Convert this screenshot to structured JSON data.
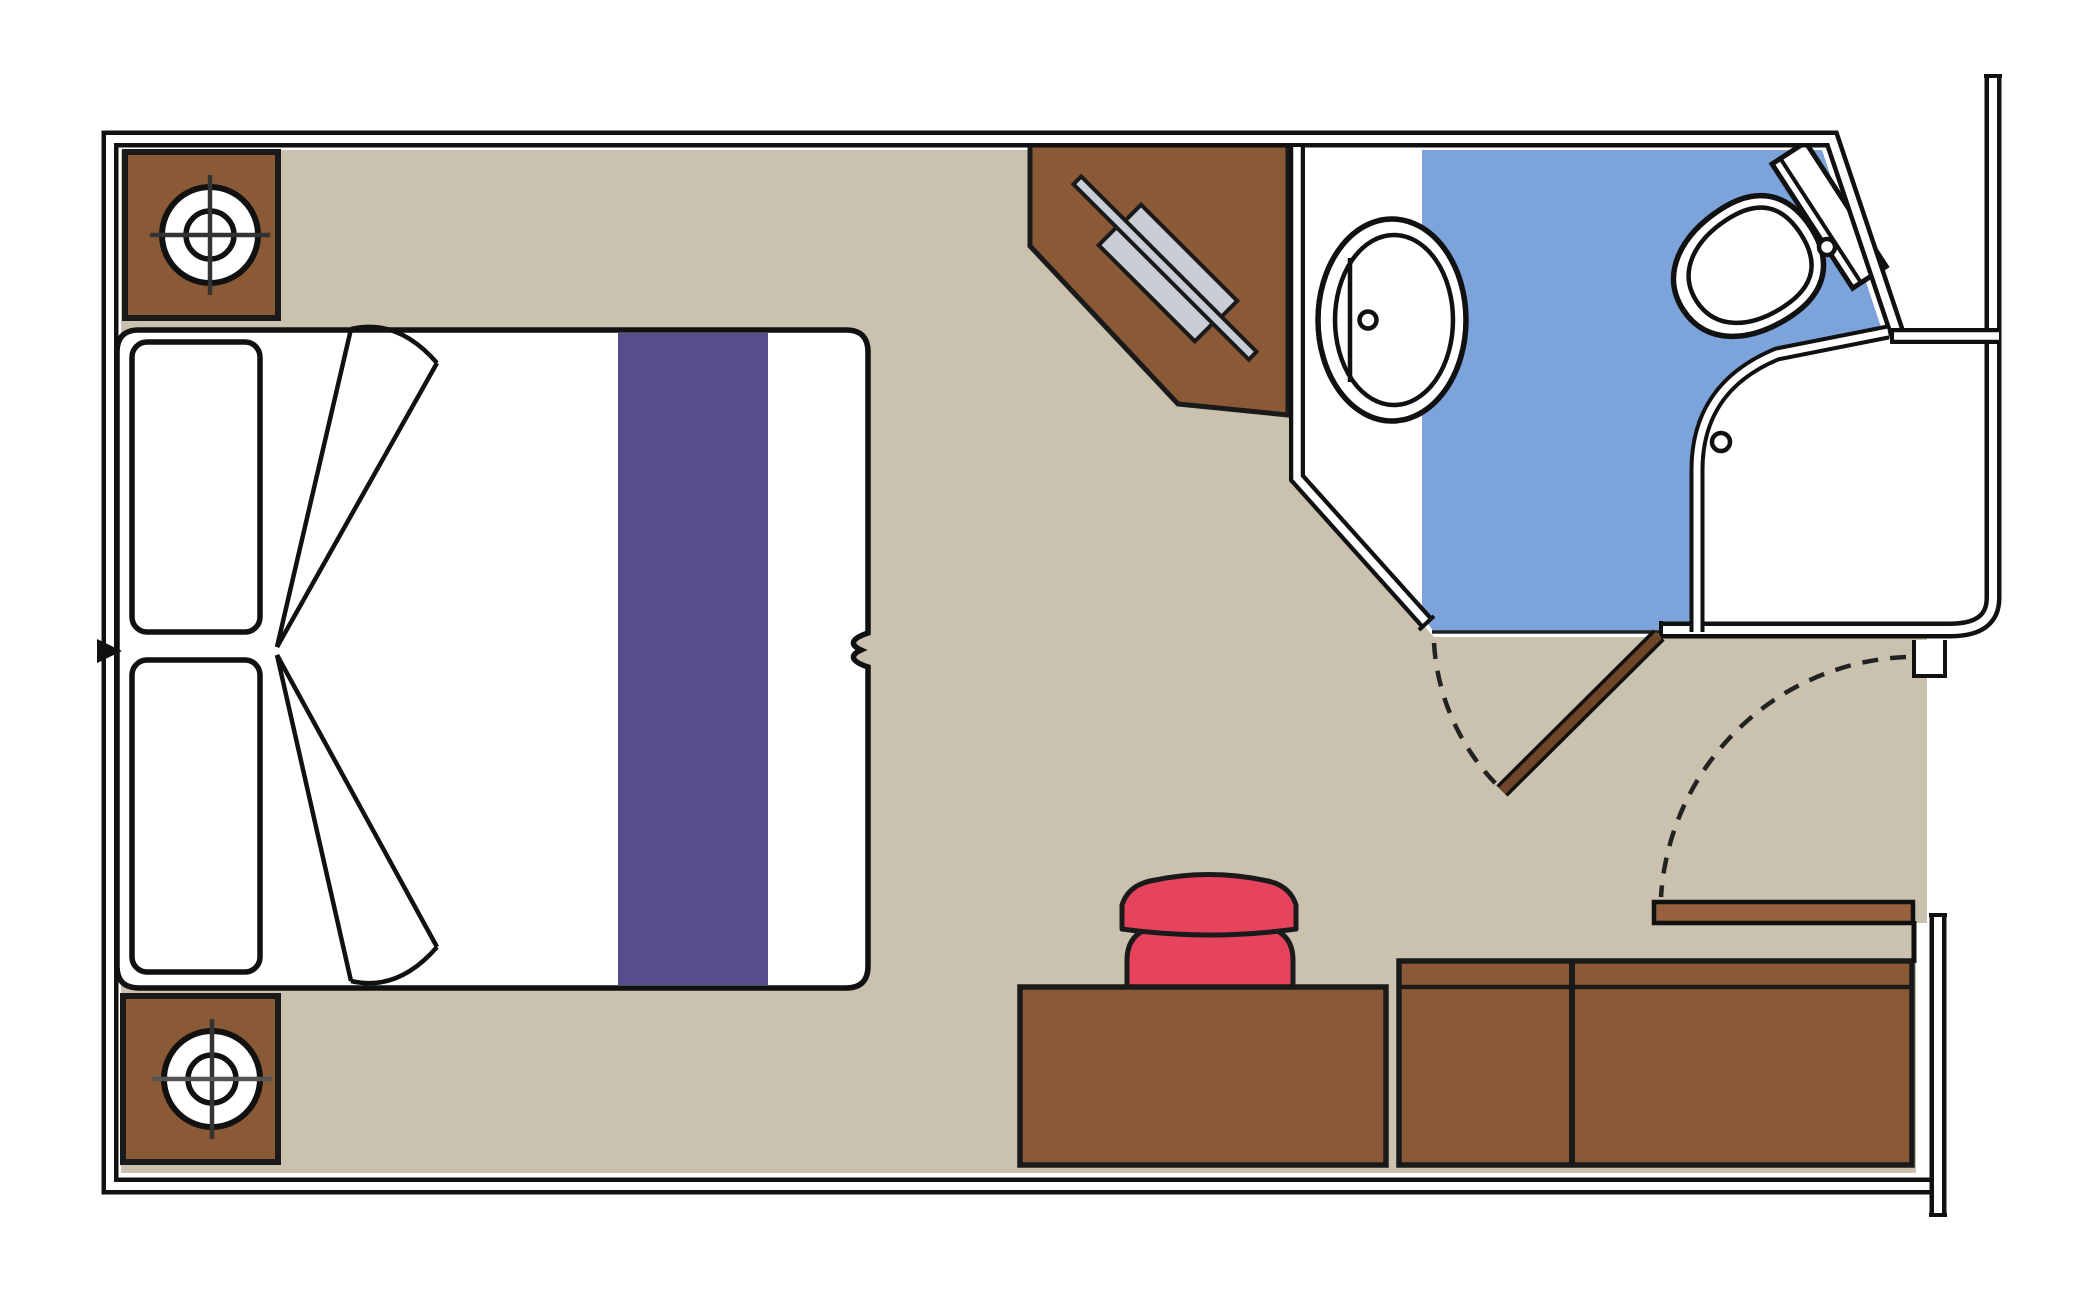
{
  "palette": {
    "background": "#ffffff",
    "floor_tan": "#cbc1af",
    "wall_fill": "#ffffff",
    "wall_line": "#111111",
    "furniture_brown": "#8a5a36",
    "entry_door_brown": "#96613c",
    "bathroom_door_brown": "#6e4526",
    "bed_runner_purple": "#574d8b",
    "bathroom_floor_blue": "#7ca4db",
    "stool_red": "#e8435c",
    "mirror_gray": "#c9ced6",
    "fixture_white": "#ffffff",
    "outline_dark": "#1a1a1a"
  },
  "elements": {
    "bed": "double-bed",
    "pillows": "two-pillows",
    "runner": "bed-runner",
    "nightstand_top": "nightstand-with-lamp",
    "nightstand_bottom": "nightstand-with-lamp",
    "vanity": "corner-vanity-with-mirror",
    "desk": "desk",
    "stool": "stool",
    "wardrobe": "wardrobe-closet",
    "bathroom": "bathroom",
    "sink": "oval-sink",
    "toilet": "toilet",
    "shower_floor": "wet-floor-area",
    "entry_door": "entry-door-open",
    "bathroom_door": "bathroom-door-open"
  }
}
